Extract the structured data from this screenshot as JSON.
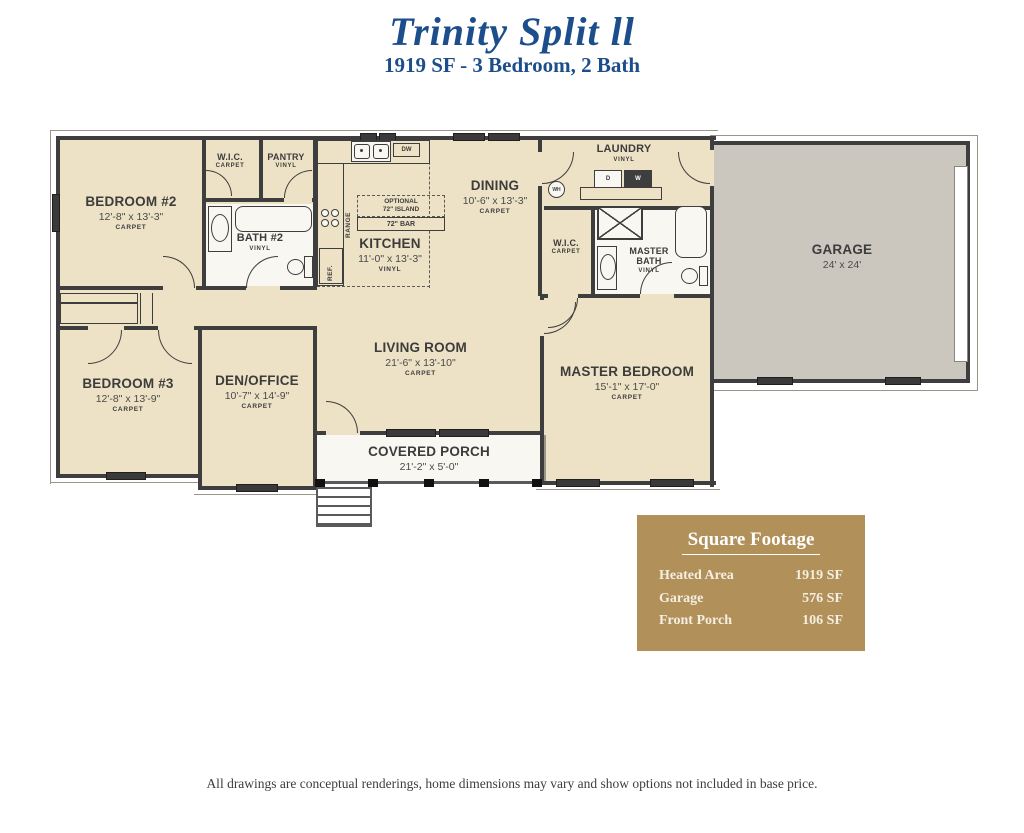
{
  "header": {
    "title": "Trinity Split ll",
    "subtitle": "1919 SF - 3 Bedroom, 2 Bath"
  },
  "rooms": {
    "bedroom2": {
      "name": "BEDROOM #2",
      "dims": "12'-8\" x 13'-3\"",
      "floor": "CARPET"
    },
    "wic2": {
      "name": "W.I.C.",
      "floor": "CARPET"
    },
    "pantry": {
      "name": "PANTRY",
      "floor": "VINYL"
    },
    "bath2": {
      "name": "BATH #2",
      "floor": "VINYL"
    },
    "kitchen": {
      "name": "KITCHEN",
      "dims": "11'-0\" x 13'-3\"",
      "floor": "VINYL"
    },
    "dining": {
      "name": "DINING",
      "dims": "10'-6\" x 13'-3\"",
      "floor": "CARPET"
    },
    "laundry": {
      "name": "LAUNDRY",
      "floor": "VINYL"
    },
    "wic_master": {
      "name": "W.I.C.",
      "floor": "CARPET"
    },
    "master_bath": {
      "name": "MASTER BATH",
      "floor": "VINYL"
    },
    "bedroom3": {
      "name": "BEDROOM #3",
      "dims": "12'-8\" x 13'-9\"",
      "floor": "CARPET"
    },
    "den_office": {
      "name": "DEN/OFFICE",
      "dims": "10'-7\" x 14'-9\"",
      "floor": "CARPET"
    },
    "living_room": {
      "name": "LIVING ROOM",
      "dims": "21'-6\" x 13'-10\"",
      "floor": "CARPET"
    },
    "master_bedroom": {
      "name": "MASTER BEDROOM",
      "dims": "15'-1\" x 17'-0\"",
      "floor": "CARPET"
    },
    "covered_porch": {
      "name": "COVERED PORCH",
      "dims": "21'-2\" x 5'-0\""
    },
    "garage": {
      "name": "GARAGE",
      "dims": "24' x 24'"
    }
  },
  "labels": {
    "dw": "DW",
    "dryer": "D",
    "washer": "W",
    "water_heater": "WH",
    "range": "RANGE",
    "ref": "REF.",
    "island_l1": "OPTIONAL",
    "island_l2": "72\" ISLAND",
    "bar": "72\" BAR"
  },
  "square_footage": {
    "title": "Square Footage",
    "rows": [
      {
        "label": "Heated Area",
        "value": "1919 SF"
      },
      {
        "label": "Garage",
        "value": "576 SF"
      },
      {
        "label": "Front Porch",
        "value": "106 SF"
      }
    ]
  },
  "disclaimer": "All drawings are conceptual renderings, home dimensions may vary and show options not included in base price.",
  "colors": {
    "accent_blue": "#1d4e8c",
    "floor_beige": "#EDE2C6",
    "garage_gray": "#CBC7BF",
    "panel_gold": "#B1905A",
    "wall": "#3E3E3E"
  }
}
